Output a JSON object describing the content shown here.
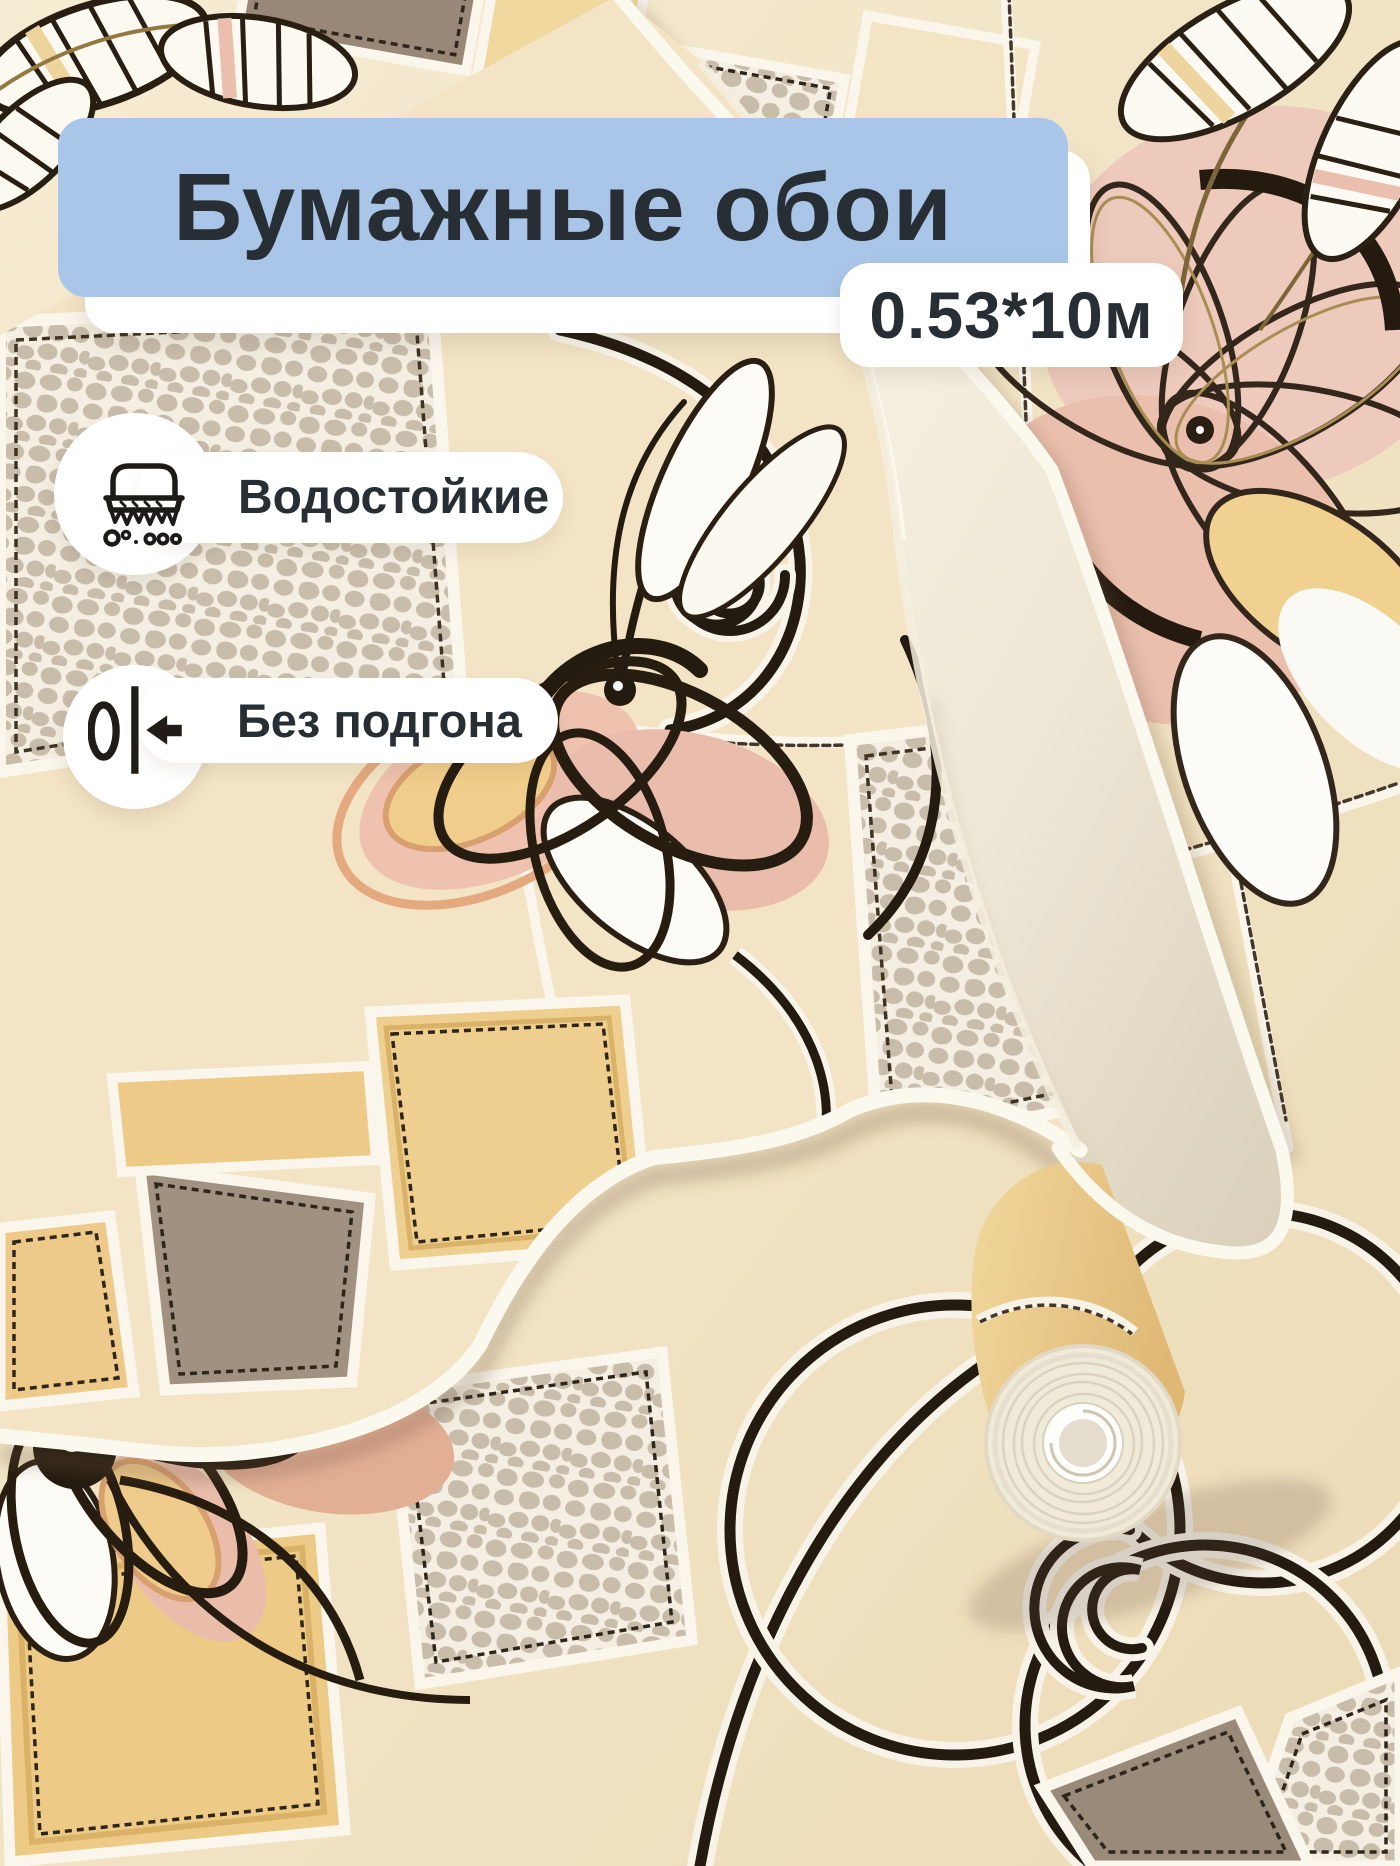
{
  "overlay": {
    "title": "Бумажные обои",
    "size_badge": "0.53*10м",
    "features": [
      {
        "icon": "scrub-brush-icon",
        "label": "Водостойкие"
      },
      {
        "icon": "no-pattern-repeat-icon",
        "label": "Без подгона"
      }
    ],
    "colors": {
      "banner_bg": "#a9c6e8",
      "card_bg": "#ffffff",
      "text": "#272e34"
    }
  },
  "photo": {
    "subject": "wallpaper-roll-on-patterned-sheet",
    "palette": {
      "cream": "#f2e4c5",
      "pale_yellow": "#f0d79f",
      "warm_yellow": "#edc986",
      "taupe": "#9c8b7a",
      "crackle_base": "#f4efe2",
      "crackle_stone": "#c8bcab",
      "petal_pink": "#ecc0ae",
      "ink_outline": "#241b10",
      "paper_ivory": "#f6f1e2"
    }
  }
}
